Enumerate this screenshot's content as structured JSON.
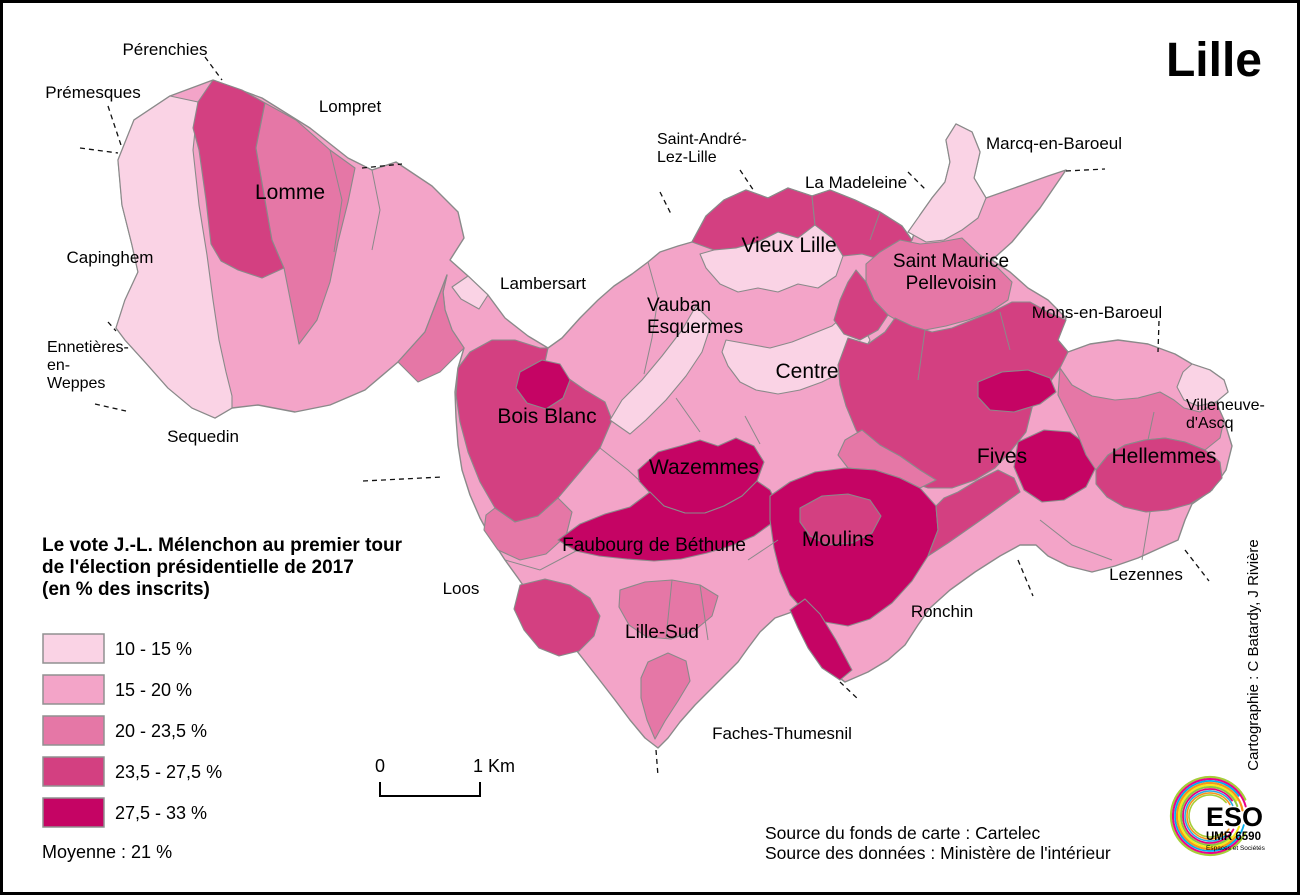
{
  "title": "Lille",
  "legend": {
    "title_lines": [
      "Le vote J.-L. Mélenchon au premier tour",
      "de l'élection présidentielle de 2017",
      "(en % des inscrits)"
    ],
    "classes": [
      {
        "label": "10 - 15 %",
        "color": "#FAD3E5"
      },
      {
        "label": "15 - 20 %",
        "color": "#F3A4C8"
      },
      {
        "label": "20 - 23,5 %",
        "color": "#E577A6"
      },
      {
        "label": "23,5 - 27,5 %",
        "color": "#D34081"
      },
      {
        "label": "27,5 - 33 %",
        "color": "#C50464"
      }
    ],
    "average": "Moyenne  : 21 %"
  },
  "scalebar": {
    "zero": "0",
    "unit": "1 Km"
  },
  "sources": [
    "Source du fonds de carte : Cartelec",
    "Source des données : Ministère de l'intérieur"
  ],
  "credit": "Cartographie : C Batardy, J Rivière",
  "logo": {
    "line1": "ESO",
    "line2": "UMR 6590",
    "line3": "Espaces et Sociétés",
    "accent": "#e6007e"
  },
  "colors": {
    "region_stroke": "#8a8a8a",
    "leader": "#111111",
    "border": "#000000",
    "label": "#000000"
  },
  "map": {
    "base_cls": 2,
    "base_pts": "213,80 262,98 310,128 348,158 372,170 396,162 432,186 458,212 464,238 450,260 468,276 488,295 505,318 528,336 548,348 562,338 580,318 598,300 614,286 632,274 648,262 660,252 678,246 692,242 706,216 724,200 746,190 768,198 788,188 812,196 830,190 855,200 880,212 902,226 912,240 920,215 932,198 945,182 950,162 946,140 956,124 972,132 980,152 974,178 986,198 1020,186 1048,176 1066,170 1040,208 1012,242 992,260 1010,272 1028,288 1048,300 1066,318 1058,340 1068,352 1090,344 1118,340 1148,344 1175,354 1192,364 1210,370 1224,380 1228,392 1216,402 1224,420 1232,446 1226,470 1212,490 1192,504 1185,520 1178,540 1160,548 1138,558 1115,566 1092,572 1068,566 1048,556 1036,545 1020,545 1000,556 975,572 950,590 930,608 918,625 905,645 888,660 868,672 845,682 826,668 812,648 800,628 792,612 775,618 760,632 748,648 738,662 725,675 710,690 695,705 680,722 668,738 658,748 645,738 630,720 615,700 598,678 580,655 562,632 545,612 532,598 518,578 505,560 492,540 480,518 470,495 462,470 458,445 456,418 455,392 458,368 464,348 452,330 445,310 443,292 447,275 425,332 398,362 365,390 330,405 295,412 258,405 232,408 215,418 192,408 168,388 145,362 125,340 116,328 125,300 138,272 132,245 122,205 118,160 134,120 170,96",
    "regions": [
      {
        "name": "premesques-pale",
        "cls": 1,
        "pts": "118,160 134,120 170,96 198,102 193,150 199,205 207,255 213,300 219,340 226,372 232,396 232,408 215,418 192,408 168,388 145,362 125,340 116,328 125,300 138,272 132,245 122,205"
      },
      {
        "name": "lomme-dark-band",
        "cls": 4,
        "pts": "198,102 213,80 242,90 265,103 256,148 265,200 272,240 284,268 262,278 238,270 221,261 211,244 206,200 199,150 193,128"
      },
      {
        "name": "lomme-core",
        "cls": 3,
        "pts": "265,103 296,120 330,150 355,168 348,202 338,242 330,282 317,320 299,344 284,268 272,240 265,200 256,148"
      },
      {
        "name": "lomme-se",
        "cls": 3,
        "pts": "398,362 425,332 447,275 443,292 445,310 452,330 464,348 440,372 418,382"
      },
      {
        "name": "corridor-sliver",
        "cls": 1,
        "pts": "468,276 488,295 479,309 461,299 452,287"
      },
      {
        "name": "bois-blanc",
        "cls": 4,
        "pts": "458,368 470,352 492,340 515,340 540,348 548,348 545,362 585,390 605,402 612,420 600,448 580,472 558,498 538,516 515,522 495,508 480,482 468,452 460,422 456,395"
      },
      {
        "name": "bois-blanc-magenta",
        "cls": 5,
        "pts": "520,372 542,360 560,364 570,380 563,398 546,409 527,403 516,388"
      },
      {
        "name": "bois-blanc-south",
        "cls": 3,
        "pts": "495,508 515,522 538,516 558,498 572,512 566,536 546,554 520,560 498,550 484,530 486,515"
      },
      {
        "name": "vauban-pale-band",
        "cls": 1,
        "pts": "610,420 622,400 642,380 662,356 682,330 696,306 712,322 702,352 686,376 666,400 646,420 630,434"
      },
      {
        "name": "vieux-lille-band-w",
        "cls": 4,
        "pts": "692,242 706,216 724,200 746,190 768,198 788,188 812,196 815,225 798,238 778,232 758,242 736,248 714,250"
      },
      {
        "name": "vieux-lille-core",
        "cls": 1,
        "pts": "714,250 736,248 758,242 778,232 798,238 815,225 832,238 843,256 836,276 818,288 798,284 778,292 758,288 738,292 720,284 706,268 700,254"
      },
      {
        "name": "vieux-lille-band-e",
        "cls": 4,
        "pts": "815,225 812,196 830,190 855,200 880,212 902,226 912,240 902,256 882,260 862,254 843,256 832,238"
      },
      {
        "name": "centre-pale",
        "cls": 1,
        "pts": "726,340 748,344 770,348 792,342 812,334 832,326 846,314 862,324 870,340 860,358 842,372 822,382 800,390 778,394 756,390 740,382 728,366 722,352"
      },
      {
        "name": "st-maurice",
        "cls": 3,
        "pts": "866,264 880,252 900,240 920,244 940,242 962,238 980,255 998,268 1012,282 1008,300 990,312 968,320 946,326 925,330 905,325 888,315 874,300 866,282"
      },
      {
        "name": "st-maurice-west",
        "cls": 4,
        "pts": "866,282 874,300 888,315 878,330 860,340 844,334 834,320 840,300 848,282 856,270"
      },
      {
        "name": "north-pale-lobe",
        "cls": 1,
        "pts": "908,232 920,215 932,198 945,182 950,162 946,140 956,124 972,132 980,152 974,178 986,198 978,218 962,230 944,240 926,242"
      },
      {
        "name": "mons-knob",
        "cls": 1,
        "pts": "1192,364 1210,370 1224,380 1228,392 1216,402 1198,406 1184,400 1177,387 1183,372"
      },
      {
        "name": "fives",
        "cls": 4,
        "pts": "848,338 868,344 885,332 895,318 912,326 932,332 952,328 972,320 992,312 1012,302 1030,302 1048,312 1066,320 1058,340 1068,352 1060,368 1048,385 1034,400 1026,432 1010,452 995,468 975,480 952,488 928,488 905,480 886,468 870,452 856,430 846,406 840,385 838,365"
      },
      {
        "name": "fives-magenta-band",
        "cls": 5,
        "pts": "978,382 1002,372 1028,370 1050,378 1056,392 1040,404 1014,412 990,410 978,397"
      },
      {
        "name": "fives-magenta-blob",
        "cls": 5,
        "pts": "1018,442 1044,430 1070,432 1090,447 1096,467 1086,487 1064,500 1042,502 1024,490 1014,467"
      },
      {
        "name": "fives-south-strip",
        "cls": 3,
        "pts": "845,440 862,430 880,445 900,456 920,470 936,480 920,488 900,478 875,470 848,468 838,455"
      },
      {
        "name": "hellemmes-north",
        "cls": 3,
        "pts": "1060,368 1072,385 1092,396 1115,400 1138,398 1160,392 1174,400 1184,408 1200,412 1216,402 1224,420 1220,438 1205,450 1185,442 1165,438 1145,440 1125,445 1108,455 1096,470 1086,455 1078,435 1068,415 1058,395"
      },
      {
        "name": "hellemmes",
        "cls": 4,
        "pts": "1096,470 1108,455 1125,445 1145,440 1165,438 1185,442 1205,450 1220,462 1222,478 1210,492 1190,504 1168,510 1146,512 1124,507 1107,497 1096,484"
      },
      {
        "name": "wazemmes",
        "cls": 5,
        "pts": "638,470 658,452 680,446 700,440 718,446 736,438 754,446 764,462 757,481 742,496 724,506 705,513 685,513 664,506 649,492 639,481"
      },
      {
        "name": "faubourg-bethune",
        "cls": 5,
        "pts": "558,540 580,524 605,514 630,507 650,492 664,506 685,513 705,513 724,506 742,496 757,481 770,490 778,506 772,523 754,536 731,546 707,553 681,559 654,561 627,559 599,556 576,551"
      },
      {
        "name": "faubourg-sw",
        "cls": 4,
        "pts": "520,585 545,579 570,585 590,598 600,616 594,636 579,651 559,656 539,648 524,630 514,609"
      },
      {
        "name": "lille-sud",
        "cls": 3,
        "pts": "620,590 645,582 672,580 700,585 718,596 712,616 694,631 671,639 647,637 629,625 619,607"
      },
      {
        "name": "lille-sud-tail",
        "cls": 3,
        "pts": "648,662 668,653 686,661 690,681 678,701 665,721 655,739 647,720 641,698 641,678"
      },
      {
        "name": "moulins",
        "cls": 5,
        "pts": "770,496 790,482 815,472 845,468 875,470 900,478 920,488 936,506 938,530 928,556 912,581 892,603 870,619 848,626 825,622 805,612 790,595 780,572 774,548 770,520"
      },
      {
        "name": "moulins-inner",
        "cls": 4,
        "pts": "800,508 822,496 848,494 870,500 881,516 872,533 852,543 828,545 810,536 800,522"
      },
      {
        "name": "moulins-triangle",
        "cls": 5,
        "pts": "790,610 798,628 808,648 822,668 840,680 852,670 836,640 820,614 805,599"
      },
      {
        "name": "moulins-east-band",
        "cls": 4,
        "pts": "936,506 938,530 928,556 948,543 968,529 988,515 1006,502 1020,492 1014,478 998,470 978,480 958,492 944,498"
      }
    ],
    "innerlines": [
      "M648,262 L658,298 L652,338 L644,374",
      "M330,150 L342,200 L334,252",
      "M372,170 L380,210 L372,250",
      "M700,585 L708,640",
      "M672,580 L666,638",
      "M1040,520 L1072,545 L1112,560",
      "M1150,512 L1142,560",
      "M925,330 L918,380",
      "M1000,312 L1010,350",
      "M676,398 L700,432",
      "M745,416 L760,444",
      "M1148,440 L1154,412",
      "M778,540 L748,560",
      "M600,448 L628,470 L640,481",
      "M880,212 L870,240",
      "M505,560 L540,570 L576,551"
    ],
    "leaders": [
      "M205,57 L222,80",
      "M108,106 L122,148",
      "M80,148 L118,153",
      "M362,168 L402,164",
      "M363,481 L442,477",
      "M108,322 L116,331",
      "M95,404 L126,411",
      "M660,192 L671,214",
      "M740,170 L754,191",
      "M908,172 L926,190",
      "M1066,171 L1105,169",
      "M1159,321 L1158,352",
      "M1185,550 L1209,581",
      "M1018,560 L1033,596",
      "M840,682 L859,700",
      "M656,750 L658,776"
    ],
    "labels": [
      {
        "id": "perenchies",
        "lines": [
          "Pérenchies"
        ],
        "x": 165,
        "y": 55,
        "size": 17
      },
      {
        "id": "premesques",
        "lines": [
          "Prémesques"
        ],
        "x": 93,
        "y": 98,
        "size": 17
      },
      {
        "id": "lompret",
        "lines": [
          "Lompret"
        ],
        "x": 350,
        "y": 112,
        "size": 17
      },
      {
        "id": "lomme",
        "lines": [
          "Lomme"
        ],
        "x": 290,
        "y": 199,
        "size": 21
      },
      {
        "id": "capinghem",
        "lines": [
          "Capinghem"
        ],
        "x": 110,
        "y": 263,
        "size": 17
      },
      {
        "id": "ennetieres",
        "lines": [
          "Ennetières-",
          "en-",
          "Weppes"
        ],
        "x": 47,
        "y": 352,
        "size": 16,
        "anchor": "start",
        "lh": 18
      },
      {
        "id": "sequedin",
        "lines": [
          "Sequedin"
        ],
        "x": 203,
        "y": 442,
        "size": 17
      },
      {
        "id": "lambersart",
        "lines": [
          "Lambersart"
        ],
        "x": 543,
        "y": 289,
        "size": 17
      },
      {
        "id": "saint-andre",
        "lines": [
          "Saint-André-",
          "Lez-Lille"
        ],
        "x": 657,
        "y": 144,
        "size": 16,
        "anchor": "start",
        "lh": 18
      },
      {
        "id": "la-madeleine",
        "lines": [
          "La Madeleine"
        ],
        "x": 856,
        "y": 188,
        "size": 17
      },
      {
        "id": "marcq",
        "lines": [
          "Marcq-en-Baroeul"
        ],
        "x": 1054,
        "y": 149,
        "size": 17
      },
      {
        "id": "vieux-lille",
        "lines": [
          "Vieux Lille"
        ],
        "x": 789,
        "y": 252,
        "size": 21
      },
      {
        "id": "st-maurice",
        "lines": [
          "Saint Maurice",
          "Pellevoisin"
        ],
        "x": 951,
        "y": 267,
        "size": 19,
        "lh": 22
      },
      {
        "id": "mons",
        "lines": [
          "Mons-en-Baroeul"
        ],
        "x": 1097,
        "y": 318,
        "size": 17
      },
      {
        "id": "vauban",
        "lines": [
          "Vauban",
          "Esquermes"
        ],
        "x": 647,
        "y": 311,
        "size": 19,
        "anchor": "start",
        "lh": 22
      },
      {
        "id": "centre",
        "lines": [
          "Centre"
        ],
        "x": 807,
        "y": 378,
        "size": 21
      },
      {
        "id": "villeneuve",
        "lines": [
          "Villeneuve-",
          "d'Ascq"
        ],
        "x": 1186,
        "y": 410,
        "size": 16,
        "anchor": "start",
        "lh": 18
      },
      {
        "id": "bois-blanc",
        "lines": [
          "Bois Blanc"
        ],
        "x": 547,
        "y": 423,
        "size": 21
      },
      {
        "id": "wazemmes",
        "lines": [
          "Wazemmes"
        ],
        "x": 704,
        "y": 474,
        "size": 21
      },
      {
        "id": "fives",
        "lines": [
          "Fives"
        ],
        "x": 1002,
        "y": 463,
        "size": 21
      },
      {
        "id": "hellemmes",
        "lines": [
          "Hellemmes"
        ],
        "x": 1164,
        "y": 463,
        "size": 21
      },
      {
        "id": "faubourg",
        "lines": [
          "Faubourg de Béthune"
        ],
        "x": 654,
        "y": 551,
        "size": 19
      },
      {
        "id": "moulins",
        "lines": [
          "Moulins"
        ],
        "x": 838,
        "y": 546,
        "size": 21
      },
      {
        "id": "lezennes",
        "lines": [
          "Lezennes"
        ],
        "x": 1146,
        "y": 580,
        "size": 17
      },
      {
        "id": "loos",
        "lines": [
          "Loos"
        ],
        "x": 461,
        "y": 594,
        "size": 17
      },
      {
        "id": "lille-sud",
        "lines": [
          "Lille-Sud"
        ],
        "x": 662,
        "y": 638,
        "size": 19
      },
      {
        "id": "ronchin",
        "lines": [
          "Ronchin"
        ],
        "x": 942,
        "y": 617,
        "size": 17
      },
      {
        "id": "faches",
        "lines": [
          "Faches-Thumesnil"
        ],
        "x": 782,
        "y": 739,
        "size": 17
      }
    ]
  },
  "logo_arcs": [
    {
      "r": 39,
      "a1": 25,
      "a2": 335,
      "color": "#a6ce39",
      "w": 2.2
    },
    {
      "r": 37,
      "a1": 35,
      "a2": 345,
      "color": "#ec008c",
      "w": 2.0
    },
    {
      "r": 35,
      "a1": 15,
      "a2": 325,
      "color": "#00aeef",
      "w": 1.8
    },
    {
      "r": 33,
      "a1": 40,
      "a2": 350,
      "color": "#f7941d",
      "w": 2.2
    },
    {
      "r": 31,
      "a1": 20,
      "a2": 330,
      "color": "#f5eb1a",
      "w": 2.0
    },
    {
      "r": 29,
      "a1": 45,
      "a2": 340,
      "color": "#8dc63f",
      "w": 2.0
    },
    {
      "r": 27,
      "a1": 30,
      "a2": 325,
      "color": "#e6007e",
      "w": 1.8
    },
    {
      "r": 25,
      "a1": 50,
      "a2": 335,
      "color": "#29abe2",
      "w": 1.6
    },
    {
      "r": 23,
      "a1": 35,
      "a2": 330,
      "color": "#f7941d",
      "w": 1.6
    },
    {
      "r": 21,
      "a1": 55,
      "a2": 320,
      "color": "#a6ce39",
      "w": 1.6
    }
  ]
}
